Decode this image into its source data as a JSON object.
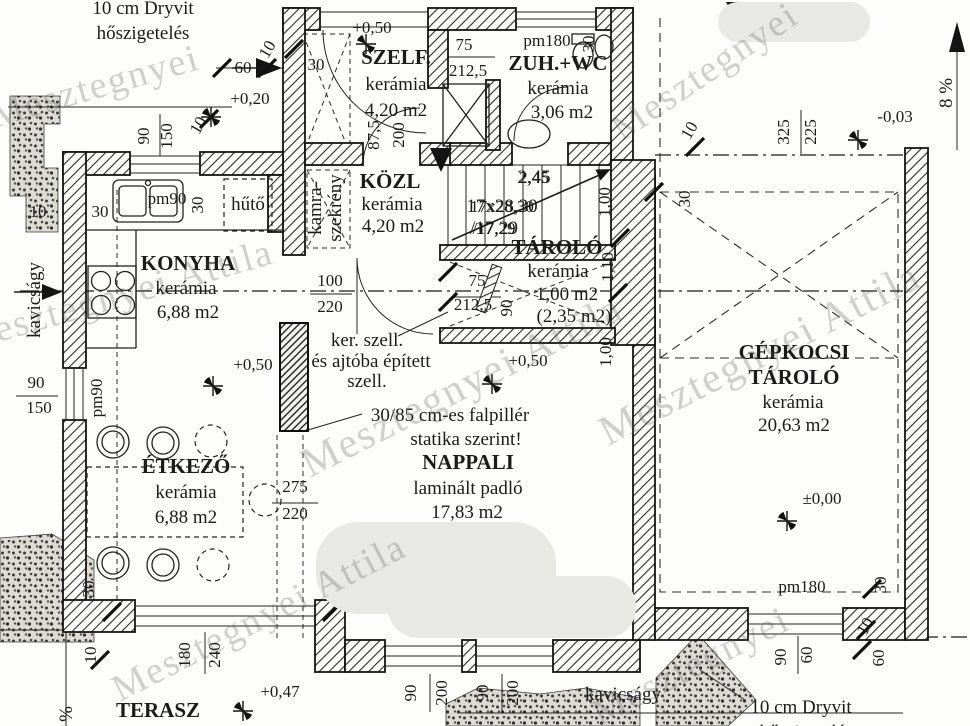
{
  "canvas": {
    "width": 970,
    "height": 726
  },
  "watermark": {
    "text": "Mesztegnyei Attila",
    "short": "Mesztegnyei"
  },
  "rooms": {
    "szelf": {
      "name": "SZELF.",
      "material": "kerámia",
      "area": "4,20 m2"
    },
    "zuhwc": {
      "name": "ZUH.+WC",
      "material": "kerámia",
      "area": "3,06 m2"
    },
    "kozl": {
      "name": "KÖZL",
      "material": "kerámia",
      "area": "4,20 m2"
    },
    "tarolo": {
      "name": "TÁROLÓ",
      "material": "kerámia",
      "area": "1,00 m2",
      "area_alt": "(2,35 m2)"
    },
    "konyha": {
      "name": "KONYHA",
      "material": "kerámia",
      "area": "6,88 m2"
    },
    "etkezo": {
      "name": "ÉTKEZŐ",
      "material": "kerámia",
      "area": "6,88 m2"
    },
    "nappali": {
      "name": "NAPPALI",
      "material": "laminált padló",
      "area": "17,83 m2"
    },
    "garage": {
      "name_line1": "GÉPKOCSI",
      "name_line2": "TÁROLÓ",
      "material": "kerámia",
      "area": "20,63 m2"
    },
    "terasz": {
      "name": "TERASZ"
    },
    "kamra": {
      "line1": "kamra-",
      "line2": "szekrény"
    }
  },
  "stairs": {
    "width": "2,45",
    "steps": "17x28,30",
    "rise": "/17,29"
  },
  "notes": {
    "insulation_top_1": "10 cm Dryvit",
    "insulation_top_2": "hőszigetelés",
    "insulation_bottom_1": "10 cm Dryvit",
    "insulation_bottom_2": "hőszigetelés",
    "vent_1": "ker. szell.",
    "vent_2": "és ajtóba épített",
    "vent_3": "szell.",
    "pillar_1": "30/85 cm-es falpillér",
    "pillar_2": "statika szerint!",
    "gravel_left": "kavicságy",
    "gravel_bottom": "kavicságy",
    "fridge": "hűtő",
    "slope": "8 %",
    "slope_terrace": "%"
  },
  "dims": [
    {
      "t": "10",
      "x": 272,
      "y": 52,
      "r": -60
    },
    {
      "t": "60",
      "x": 243,
      "y": 73
    },
    {
      "t": "30",
      "x": 316,
      "y": 70
    },
    {
      "t": "+0,20",
      "x": 250,
      "y": 104
    },
    {
      "t": "90",
      "x": 149,
      "y": 136,
      "r": -90
    },
    {
      "t": "150",
      "x": 172,
      "y": 136,
      "r": -90
    },
    {
      "t": "10",
      "x": 203,
      "y": 128,
      "r": -60
    },
    {
      "t": "+0,50",
      "x": 372,
      "y": 33
    },
    {
      "t": "75",
      "x": 464,
      "y": 50
    },
    {
      "t": "212,5",
      "x": 468,
      "y": 76
    },
    {
      "t": "pm180",
      "x": 547,
      "y": 46
    },
    {
      "t": "30",
      "x": 594,
      "y": 44,
      "r": -90
    },
    {
      "t": "87,5",
      "x": 379,
      "y": 135,
      "r": -90
    },
    {
      "t": "200",
      "x": 404,
      "y": 135,
      "r": -90
    },
    {
      "t": "10",
      "x": 694,
      "y": 133,
      "r": -60
    },
    {
      "t": "325",
      "x": 789,
      "y": 132,
      "r": -90
    },
    {
      "t": "225",
      "x": 816,
      "y": 132,
      "r": -90
    },
    {
      "t": "-0,03",
      "x": 895,
      "y": 122
    },
    {
      "t": "pm90",
      "x": 167,
      "y": 204
    },
    {
      "t": "30",
      "x": 203,
      "y": 205,
      "r": -90
    },
    {
      "t": "30",
      "x": 100,
      "y": 217
    },
    {
      "t": "10",
      "x": 38,
      "y": 217
    },
    {
      "t": "2,45",
      "x": 534,
      "y": 183
    },
    {
      "t": "17x28,30",
      "x": 502,
      "y": 212
    },
    {
      "t": "/17,29",
      "x": 494,
      "y": 234
    },
    {
      "t": "1,00",
      "x": 610,
      "y": 202,
      "r": -90
    },
    {
      "t": "1,10",
      "x": 613,
      "y": 267,
      "r": -90
    },
    {
      "t": "1,00",
      "x": 611,
      "y": 352,
      "r": -90
    },
    {
      "t": "30",
      "x": 690,
      "y": 199,
      "r": -90
    },
    {
      "t": "100",
      "x": 330,
      "y": 286
    },
    {
      "t": "220",
      "x": 330,
      "y": 312
    },
    {
      "t": "75",
      "x": 477,
      "y": 286
    },
    {
      "t": "212,5",
      "x": 473,
      "y": 310
    },
    {
      "t": "90",
      "x": 512,
      "y": 308,
      "r": -90
    },
    {
      "t": "+0,50",
      "x": 253,
      "y": 370
    },
    {
      "t": "+0,50",
      "x": 528,
      "y": 366
    },
    {
      "t": "90",
      "x": 36,
      "y": 388
    },
    {
      "t": "150",
      "x": 39,
      "y": 413
    },
    {
      "t": "pm90",
      "x": 102,
      "y": 398,
      "r": -90
    },
    {
      "t": "275",
      "x": 295,
      "y": 492
    },
    {
      "t": "220",
      "x": 295,
      "y": 519
    },
    {
      "t": "±0,00",
      "x": 822,
      "y": 504
    },
    {
      "t": "30",
      "x": 94,
      "y": 589,
      "r": -90
    },
    {
      "t": "10",
      "x": 96,
      "y": 655,
      "r": -90
    },
    {
      "t": "180",
      "x": 190,
      "y": 655,
      "r": -90
    },
    {
      "t": "240",
      "x": 220,
      "y": 655,
      "r": -90
    },
    {
      "t": "+0,47",
      "x": 280,
      "y": 697
    },
    {
      "t": "90",
      "x": 416,
      "y": 693,
      "r": -90
    },
    {
      "t": "200",
      "x": 447,
      "y": 693,
      "r": -90
    },
    {
      "t": "90",
      "x": 488,
      "y": 693,
      "r": -90
    },
    {
      "t": "200",
      "x": 518,
      "y": 693,
      "r": -90
    },
    {
      "t": "pm180",
      "x": 802,
      "y": 592
    },
    {
      "t": "90",
      "x": 786,
      "y": 657,
      "r": -90
    },
    {
      "t": "60",
      "x": 812,
      "y": 655,
      "r": -90
    },
    {
      "t": "30",
      "x": 886,
      "y": 585,
      "r": -90
    },
    {
      "t": "10",
      "x": 870,
      "y": 629,
      "r": -60
    },
    {
      "t": "60",
      "x": 884,
      "y": 658,
      "r": -90
    }
  ]
}
